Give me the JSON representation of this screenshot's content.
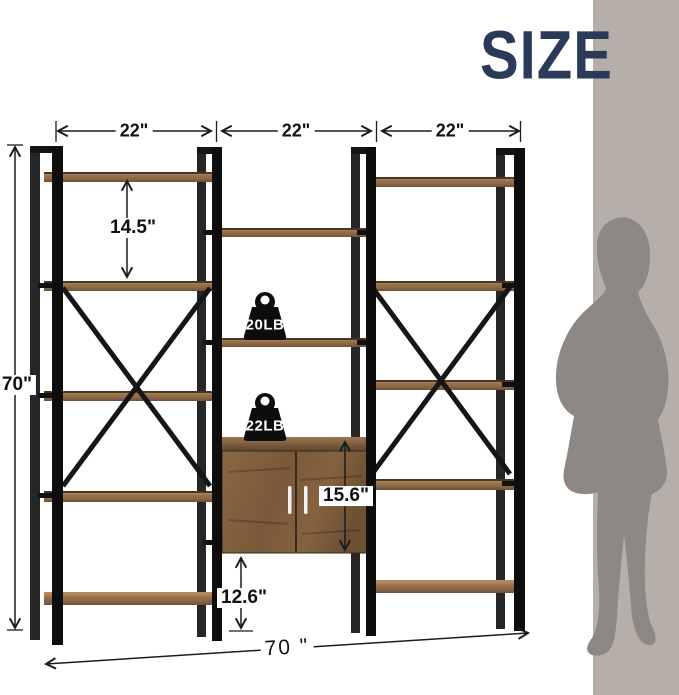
{
  "header": {
    "title": "SIZE"
  },
  "dimensions": {
    "bay_widths": [
      "22\"",
      "22\"",
      "22\""
    ],
    "overall_height": "70\"",
    "shelf_spacing": "14.5\"",
    "cabinet_height": "15.6\"",
    "bottom_clearance": "12.6\"",
    "overall_width": "70 \""
  },
  "load_capacity": {
    "shelf_weight": "20LB",
    "cabinet_weight": "22LB"
  },
  "colors": {
    "accent_navy": "#2b3a58",
    "frame_black": "#161616",
    "shelf_wood": "#9a734c",
    "cabinet_wood": "#7d5c3c",
    "panel_gray": "#b6afa9",
    "silhouette_gray": "#8e8885"
  }
}
